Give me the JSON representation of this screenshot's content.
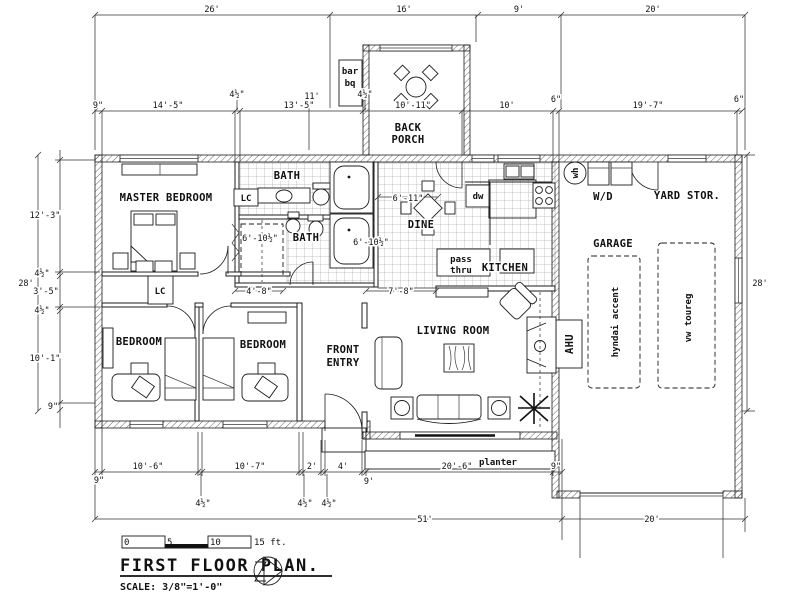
{
  "colors": {
    "line": "#1c1c1c",
    "bg": "#ffffff"
  },
  "labels": {
    "master_bedroom": "MASTER BEDROOM",
    "bath_top": "BATH",
    "bath_bottom": "BATH",
    "lc_bath": "LC",
    "lc_hall": "LC",
    "back_porch_line1": "BACK",
    "back_porch_line2": "PORCH",
    "barbq_line1": "bar",
    "barbq_line2": "bq",
    "dine": "DINE",
    "kitchen": "KITCHEN",
    "pass_line1": "pass",
    "pass_line2": "thru",
    "dw": "dw",
    "wh": "wh",
    "wd": "W/D",
    "yard_stor": "YARD STOR.",
    "garage": "GARAGE",
    "car_left": "hyndai accent",
    "car_right": "vw toureg",
    "ahu": "AHU",
    "living_room": "LIVING ROOM",
    "front_entry_line1": "FRONT",
    "front_entry_line2": "ENTRY",
    "bedroom_left": "BEDROOM",
    "bedroom_right": "BEDROOM",
    "planter": "planter"
  },
  "dims": {
    "top_26": "26'",
    "top_16": "16'",
    "top_9": "9'",
    "top_20": "20'",
    "row2_9in": "9\"",
    "row2_14_5": "14'-5\"",
    "row2_4h_left": "4½\"",
    "row2_13_5": "13'-5\"",
    "row2_11": "11'",
    "row2_4h_right": "4½\"",
    "row2_10_11": "10'-11\"",
    "row2_10": "10'",
    "row2_6_left": "6\"",
    "row2_19_7": "19'-7\"",
    "row2_6_right": "6\"",
    "left_28": "28'",
    "left_12_3": "12'-3\"",
    "left_4h_top": "4½\"",
    "left_3_5": "3'-5\"",
    "left_4h_bot": "4½\"",
    "left_10_1": "10'-1\"",
    "left_9in": "9\"",
    "right_28": "28'",
    "bot_9in_left": "9\"",
    "bot_10_6": "10'-6\"",
    "bot_4h_1": "4½\"",
    "bot_10_7": "10'-7\"",
    "bot_4h_2": "4½\"",
    "bot_2": "2'",
    "bot_4h_3": "4½\"",
    "bot_4": "4'",
    "bot_9ft": "9'",
    "bot_20_6": "20'-6\"",
    "bot_9in_right": "9\"",
    "bot_51": "51'",
    "bot_20": "20'",
    "closet_6_10h": "6'-10½\"",
    "closet_4_8": "4'-8\"",
    "dine_6_11": "6'-11\"",
    "dine_6_10h": "6'-10½\"",
    "hall_7_8": "7'-8\""
  },
  "title_block": {
    "title": "FIRST FLOOR PLAN.",
    "scale": "SCALE: 3/8\"=1'-0\"",
    "bar_0": "0",
    "bar_5": "5",
    "bar_10": "10",
    "bar_15": "15 ft."
  }
}
